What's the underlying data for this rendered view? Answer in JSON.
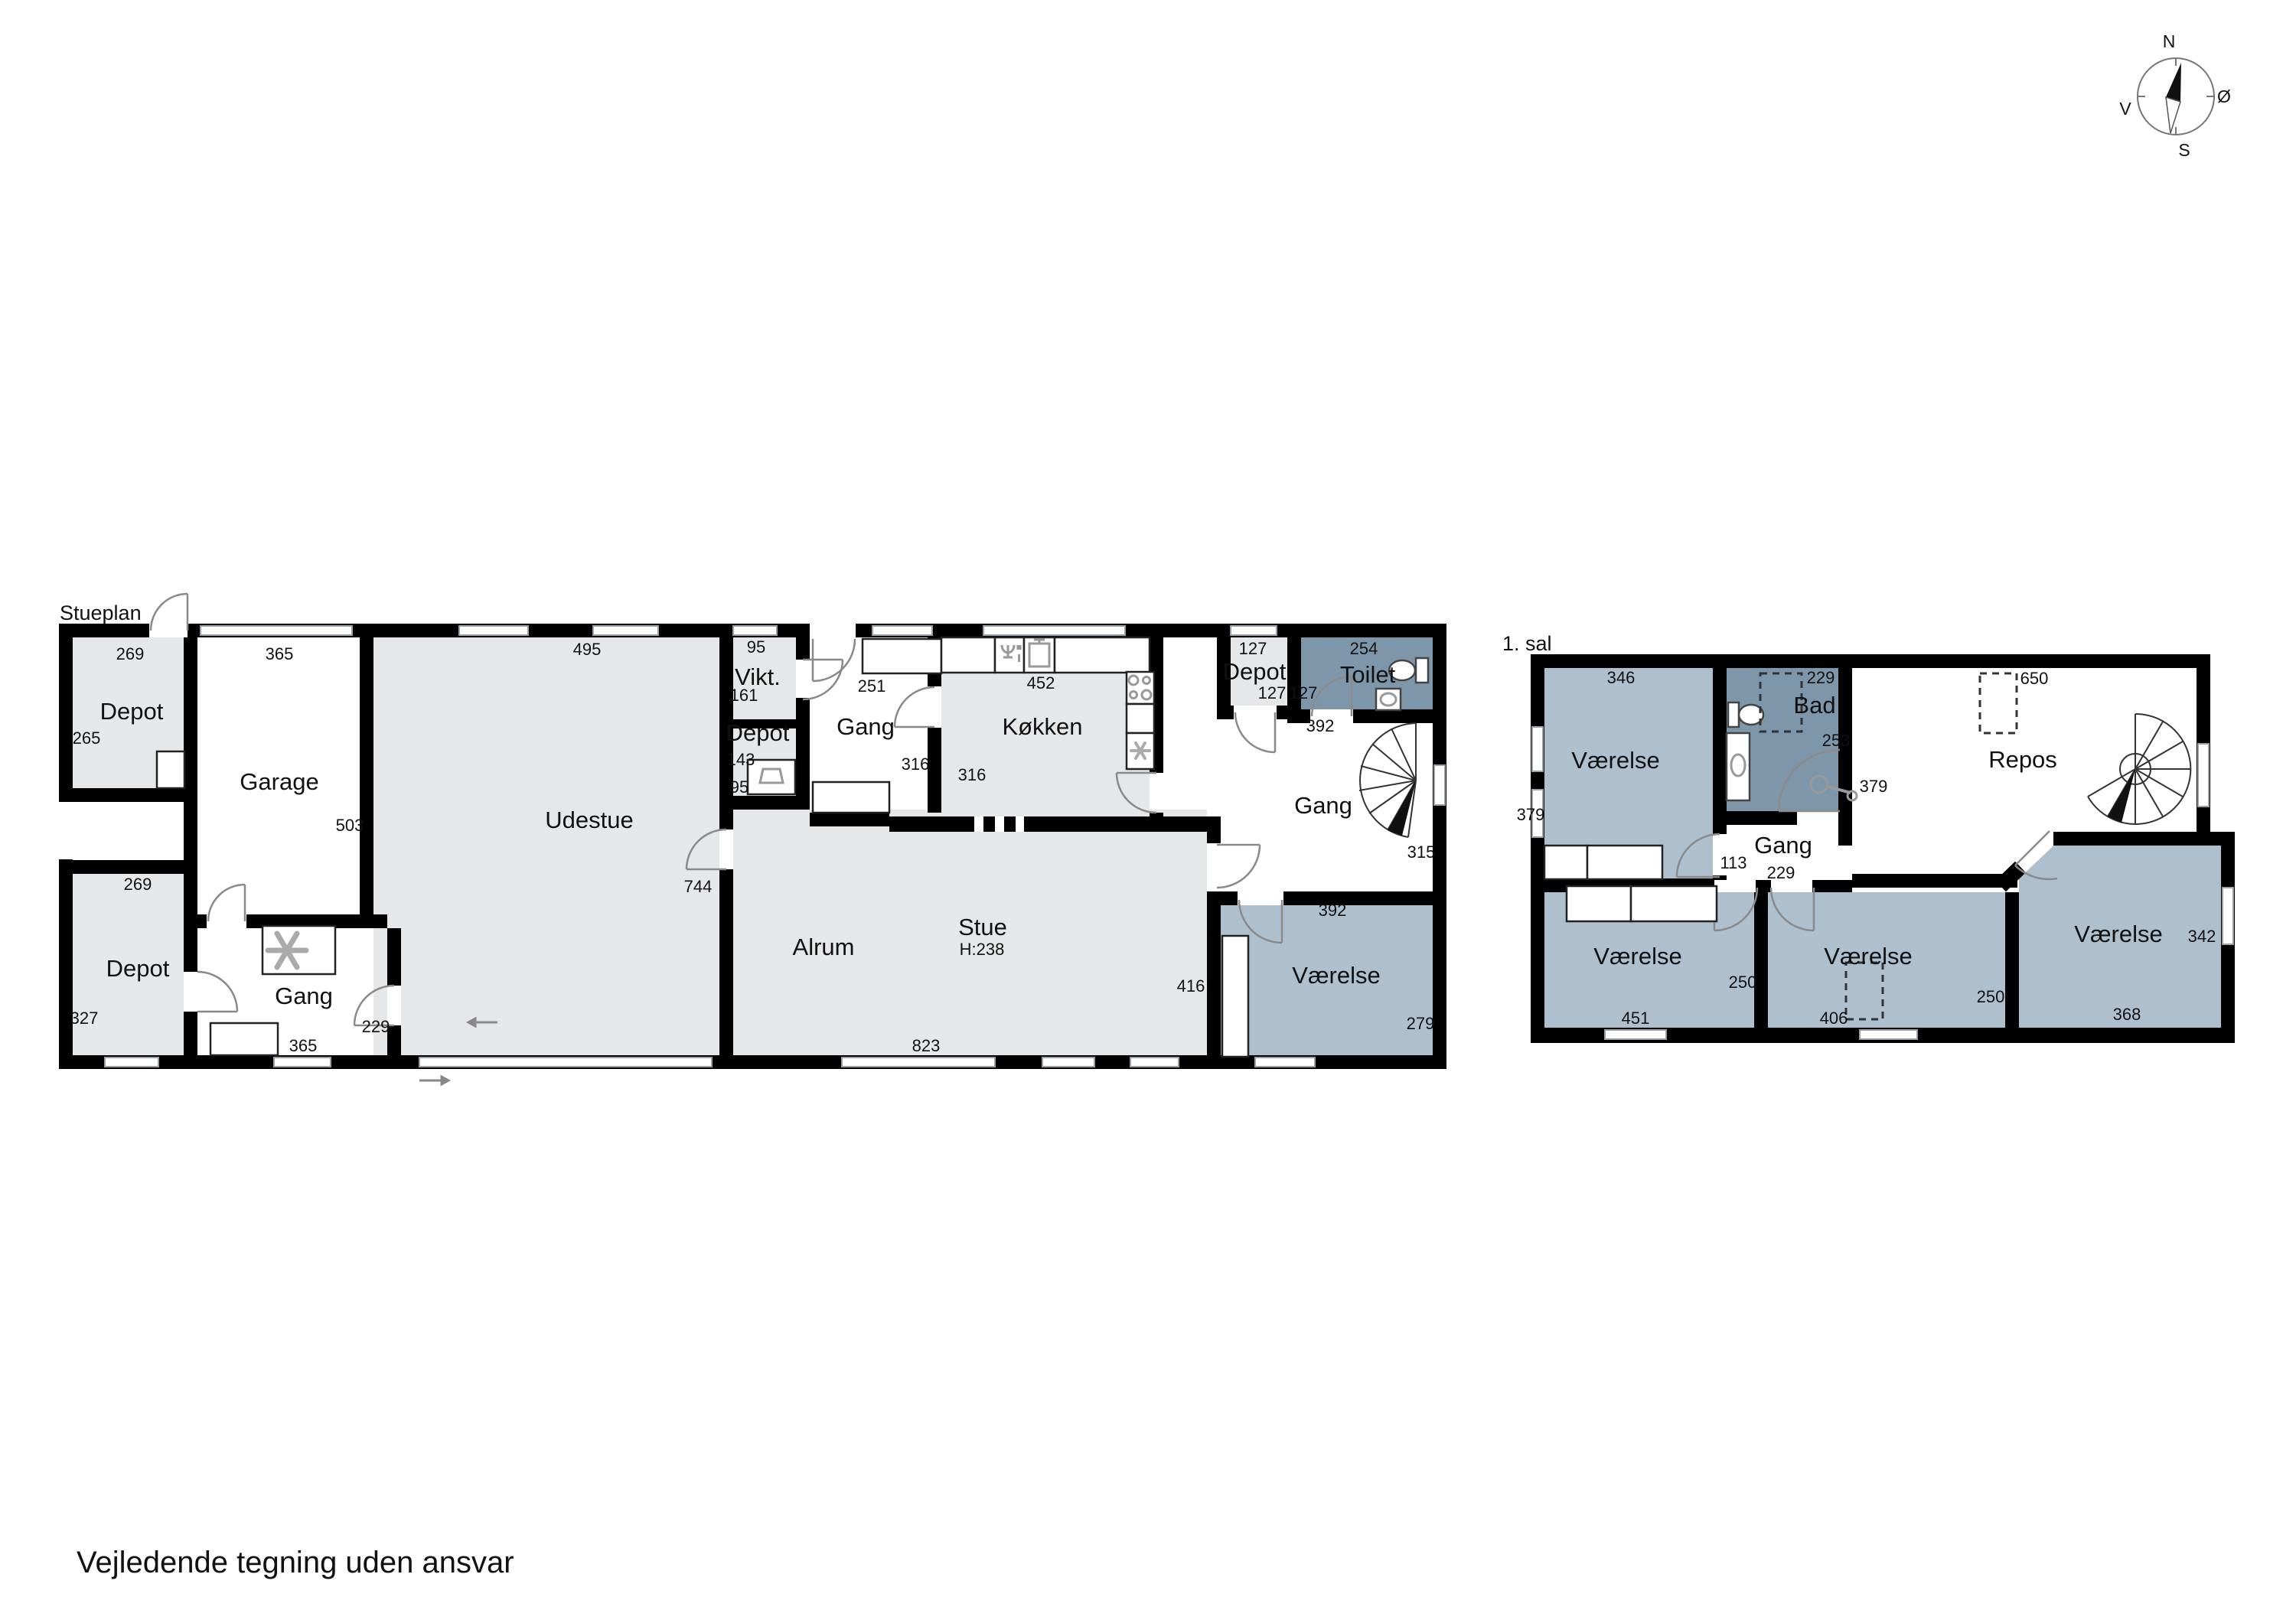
{
  "document": {
    "footer": "Vejledende tegning uden ansvar"
  },
  "compass": {
    "n": "N",
    "s": "S",
    "e": "Ø",
    "w": "V"
  },
  "colors": {
    "wall": "#000000",
    "room_grey": "#e6e7e9",
    "room_blue": "#aebfce",
    "room_dark_blue": "#7e96a9",
    "window_line": "#9aa0a6"
  },
  "ground_floor": {
    "title": "Stueplan",
    "rooms": [
      {
        "name": "depot-nw",
        "label": "Depot",
        "dims": {
          "top": "269",
          "side": "265"
        }
      },
      {
        "name": "garage",
        "label": "Garage",
        "dims": {
          "top": "365",
          "side": "503"
        }
      },
      {
        "name": "depot-sw",
        "label": "Depot",
        "dims": {
          "top": "269",
          "side": "327"
        }
      },
      {
        "name": "gang-sw",
        "label": "Gang",
        "dims": {
          "side": "229",
          "bottom": "365"
        }
      },
      {
        "name": "udestue",
        "label": "Udestue",
        "dims": {
          "top": "495",
          "side": "744"
        }
      },
      {
        "name": "vikt",
        "label": "Vikt.",
        "dims": {
          "top": "95",
          "side": "161"
        }
      },
      {
        "name": "depot-mid",
        "label": "Depot",
        "dims": {
          "top": "143",
          "side": "95"
        }
      },
      {
        "name": "gang-mid",
        "label": "Gang",
        "dims": {
          "top": "251",
          "side": "316"
        }
      },
      {
        "name": "kokken",
        "label": "Køkken",
        "dims": {
          "top": "452",
          "side": "316"
        }
      },
      {
        "name": "depot-ne",
        "label": "Depot",
        "dims": {
          "top": "127",
          "side": "127"
        }
      },
      {
        "name": "toilet",
        "label": "Toilet",
        "dims": {
          "top": "254",
          "side": "127"
        }
      },
      {
        "name": "gang-right",
        "label": "Gang",
        "dims": {
          "top": "392",
          "side": "315"
        }
      },
      {
        "name": "alrum",
        "label": "Alrum",
        "dims": {}
      },
      {
        "name": "stue",
        "label": "Stue",
        "height_note": "H:238",
        "dims": {
          "side": "416",
          "bottom": "823"
        }
      },
      {
        "name": "vaerelse",
        "label": "Værelse",
        "dims": {
          "top": "392",
          "side": "279"
        }
      }
    ]
  },
  "first_floor": {
    "title": "1. sal",
    "rooms": [
      {
        "name": "vaerelse-nw",
        "label": "Værelse",
        "dims": {
          "top": "346",
          "side": "379"
        }
      },
      {
        "name": "bad",
        "label": "Bad",
        "dims": {
          "top": "229",
          "side": "253"
        }
      },
      {
        "name": "gang",
        "label": "Gang",
        "dims": {
          "side": "113",
          "bottom": "229"
        }
      },
      {
        "name": "repos",
        "label": "Repos",
        "dims": {
          "top": "650",
          "side": "379"
        }
      },
      {
        "name": "vaerelse-sw",
        "label": "Værelse",
        "dims": {
          "side": "250",
          "bottom": "451"
        }
      },
      {
        "name": "vaerelse-s",
        "label": "Værelse",
        "dims": {
          "side": "250",
          "bottom": "406"
        }
      },
      {
        "name": "vaerelse-se",
        "label": "Værelse",
        "dims": {
          "side": "342",
          "bottom": "368"
        }
      }
    ]
  }
}
